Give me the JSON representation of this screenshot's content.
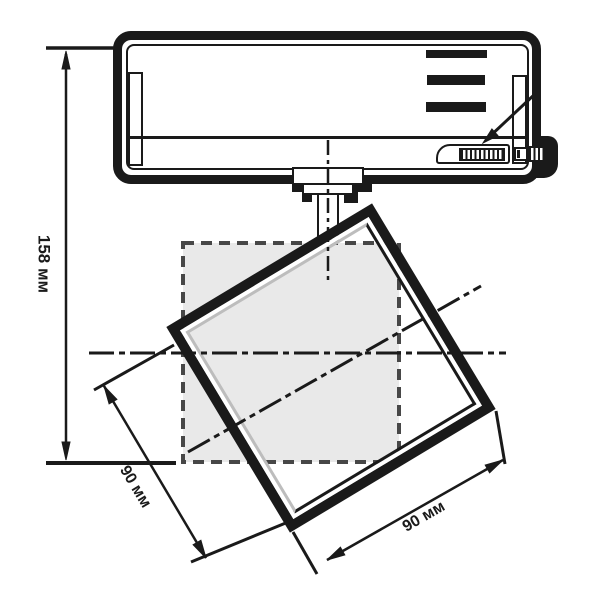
{
  "dimensions": {
    "height_label": "158 мм",
    "width_left_label": "90 мм",
    "width_right_label": "90 мм"
  },
  "colors": {
    "line": "#1a1a1a",
    "ghost_fill": "#e9e9e9",
    "ghost_dash": "#474747",
    "bezel_highlight": "#bdbdbd"
  }
}
